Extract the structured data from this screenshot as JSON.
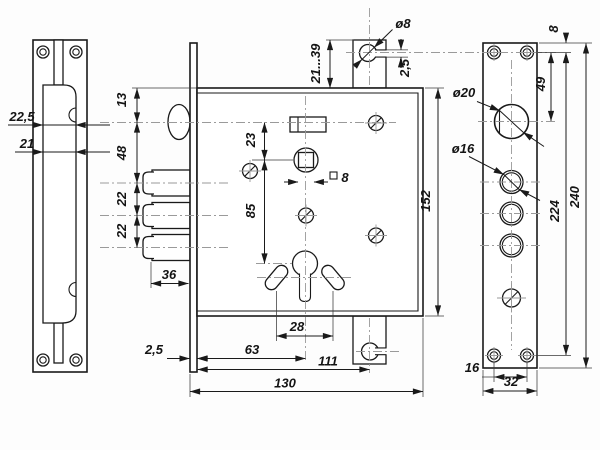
{
  "meta": {
    "domain": "technical-drawing",
    "subject": "Mortise door lock with three deadbolts, latch, euro-cylinder keyhole and two strike plates — dimensioned engineering drawing"
  },
  "dims": {
    "left": {
      "coverWidth": "22,5",
      "boltWidth": "21"
    },
    "center": {
      "topToLatch": "13",
      "latchToBolt": "48",
      "boltGap1": "22",
      "boltGap2": "22",
      "boltLength": "36",
      "plateThickness": "2,5",
      "latchToFollower": "23",
      "followerToCylinder": "85",
      "followerSquare": "8",
      "pinDiameter": "ø8",
      "pinNotch": "2,5",
      "adjustRange": "21...39",
      "ovalSpan": "28",
      "cylinderBackset": "63",
      "blockBackset": "111",
      "caseDepth": "130",
      "caseHeight": "152"
    },
    "right": {
      "holeDiameter": "ø20",
      "ringDiameter": "ø16",
      "edgeToScrew": "8",
      "screwToHole": "49",
      "screwSpan": "224",
      "plateLength": "240",
      "screwGap": "16",
      "plateWidth": "32"
    }
  }
}
